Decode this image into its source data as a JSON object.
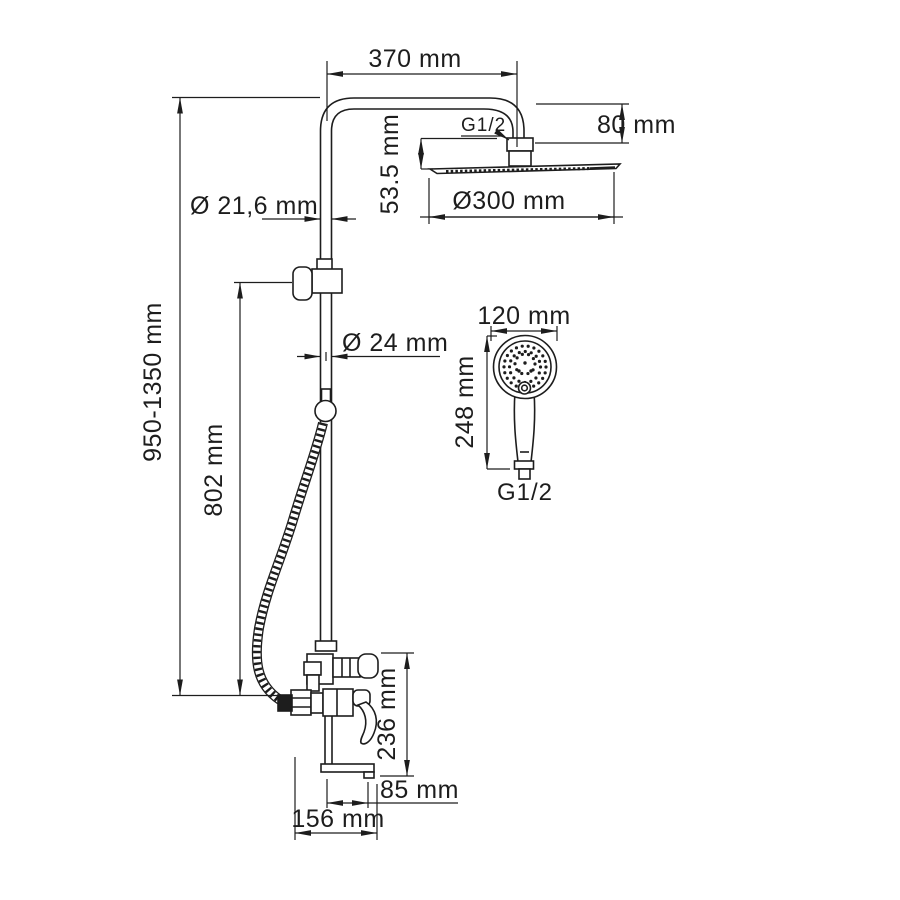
{
  "drawing": {
    "colors": {
      "line": "#1d1d1d",
      "background": "#ffffff"
    },
    "labels": {
      "top_width": "370 mm",
      "head_height": "80 mm",
      "arm_thread": "G1/2",
      "head_offset": "53.5 mm",
      "head_diameter": "Ø300 mm",
      "upper_pipe_diameter": "Ø 21,6 mm",
      "overall_height": "950-1350 mm",
      "lower_pipe_diameter": "Ø 24 mm",
      "bracket_height": "802 mm",
      "handshower_width": "120 mm",
      "handshower_height": "248 mm",
      "handshower_thread": "G1/2",
      "mixer_height": "236 mm",
      "spout_reach": "85 mm",
      "mixer_width": "156 mm"
    }
  }
}
